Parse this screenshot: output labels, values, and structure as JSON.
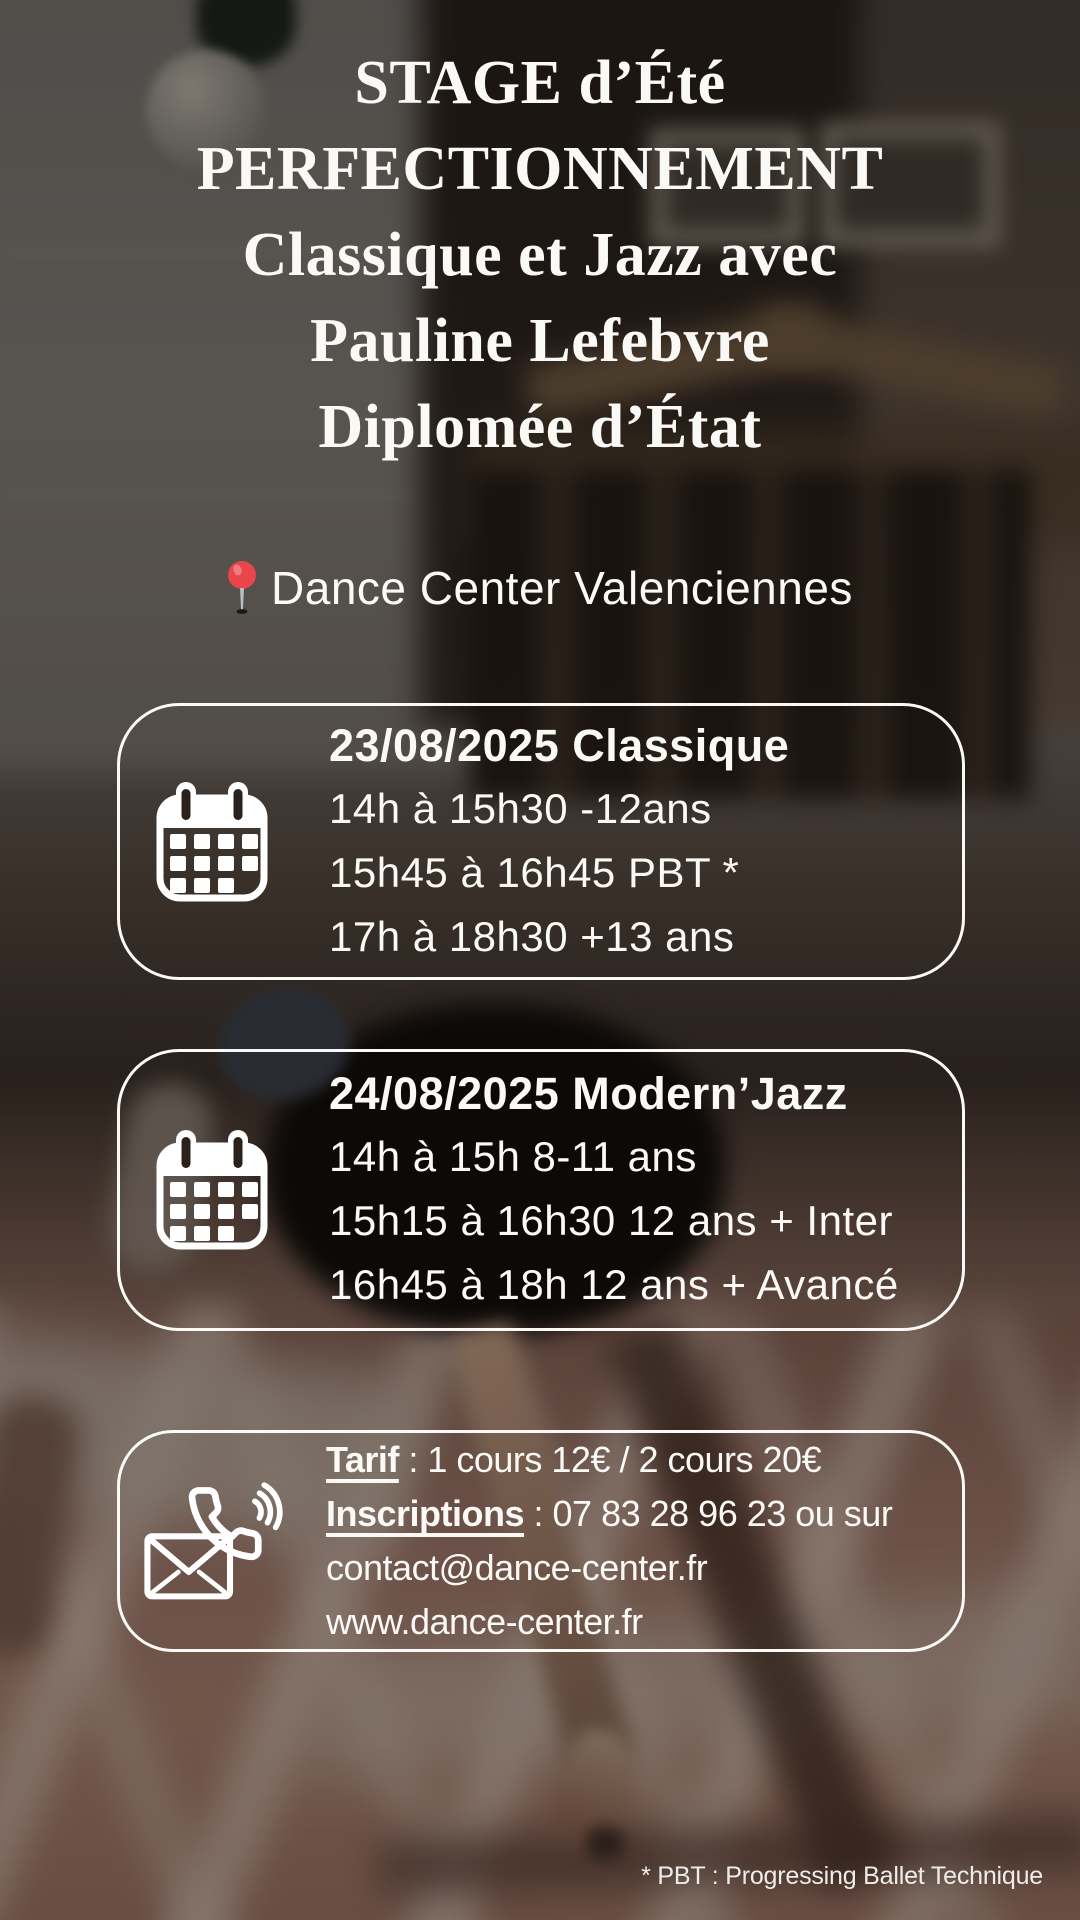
{
  "poster": {
    "title_lines": [
      "STAGE d’Été",
      "PERFECTIONNEMENT",
      "Classique et Jazz avec",
      "Pauline Lefebvre",
      "Diplomée d’État"
    ],
    "location": {
      "icon": "round-pushpin-icon",
      "label": "Dance Center Valenciennes"
    },
    "sessions": [
      {
        "icon": "calendar-icon",
        "title": "23/08/2025 Classique",
        "lines": [
          "14h à 15h30 -12ans",
          "15h45 à 16h45 PBT *",
          "17h à 18h30 +13 ans"
        ]
      },
      {
        "icon": "calendar-icon",
        "title": "24/08/2025 Modern’Jazz",
        "lines": [
          "14h à 15h 8-11 ans",
          "15h15 à 16h30 12 ans + Inter",
          "16h45 à 18h 12 ans + Avancé"
        ]
      }
    ],
    "contact": {
      "icon": "phone-mail-icon",
      "tarif_label": "Tarif",
      "tarif_rest": " : 1 cours 12€ / 2 cours 20€",
      "inscriptions_label": "Inscriptions",
      "inscriptions_rest": " : 07 83 28 96 23 ou sur",
      "email": "contact@dance-center.fr",
      "website": "www.dance-center.fr"
    },
    "footnote": "* PBT : Progressing Ballet Technique",
    "colors": {
      "text": "#fbf9f6",
      "box_border": "#fbf9f6",
      "pin_red": "#e8464b",
      "pin_stem": "#b9bdc2",
      "icon_white": "#ffffff"
    }
  }
}
